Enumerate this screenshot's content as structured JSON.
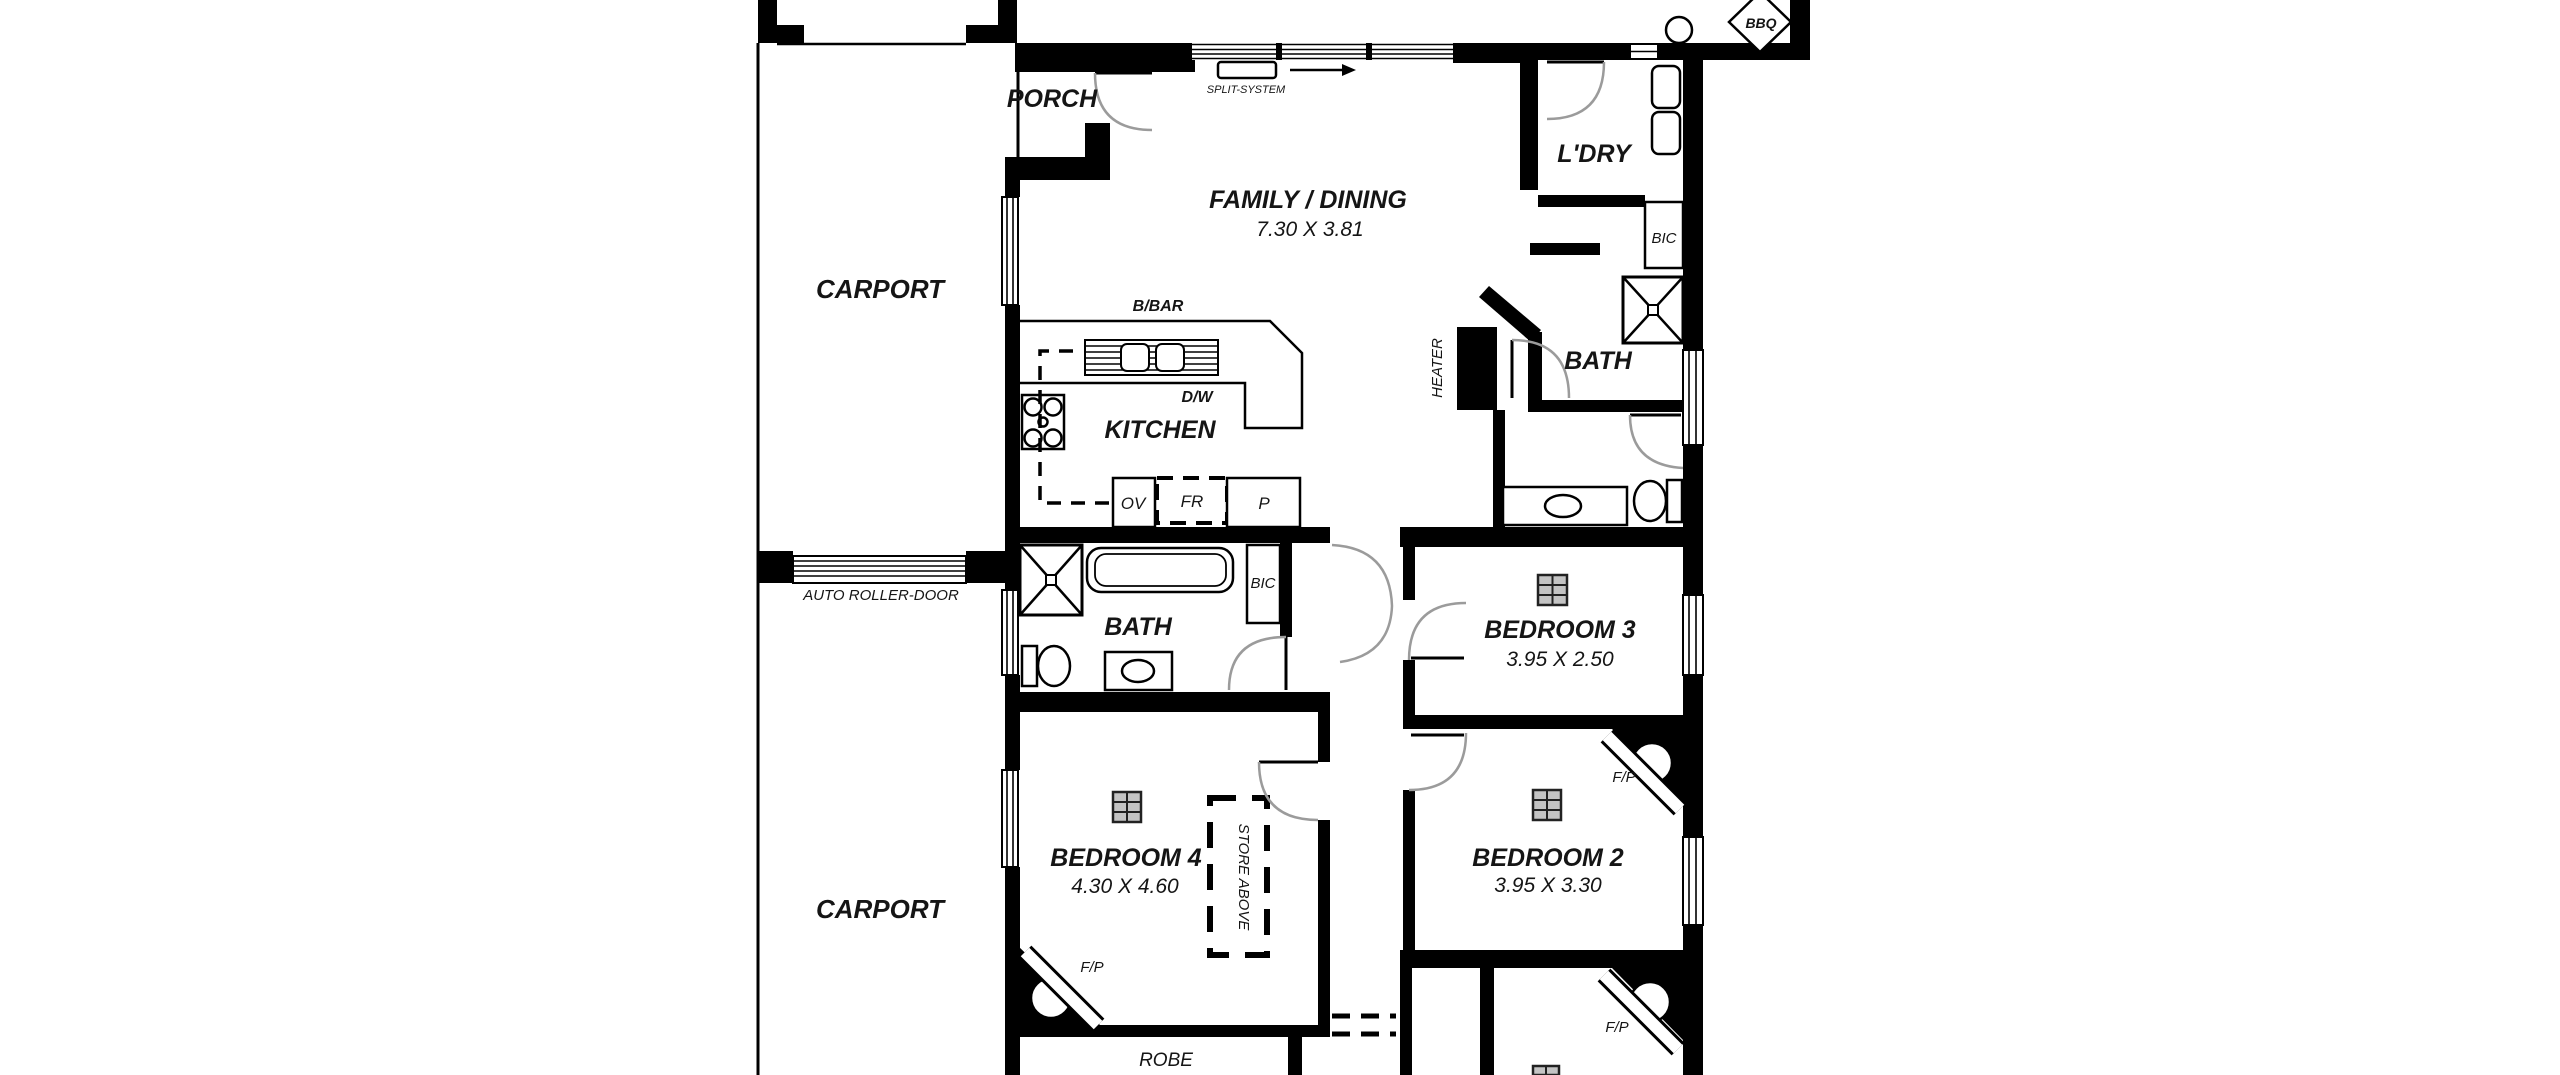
{
  "plan": {
    "rooms": {
      "carport_front": {
        "label": "CARPORT"
      },
      "carport_rear": {
        "label": "CARPORT"
      },
      "porch": {
        "label": "PORCH"
      },
      "family_dining": {
        "label": "FAMILY / DINING",
        "dims": "7.30 X 3.81"
      },
      "kitchen": {
        "label": "KITCHEN"
      },
      "laundry": {
        "label": "L'DRY"
      },
      "bath_main": {
        "label": "BATH"
      },
      "bath_two": {
        "label": "BATH"
      },
      "bedroom2": {
        "label": "BEDROOM 2",
        "dims": "3.95 X 3.30"
      },
      "bedroom3": {
        "label": "BEDROOM 3",
        "dims": "3.95 X 2.50"
      },
      "bedroom4": {
        "label": "BEDROOM 4",
        "dims": "4.30 X 4.60"
      },
      "robe": {
        "label": "ROBE"
      }
    },
    "annotations": {
      "split_system": "SPLIT-SYSTEM",
      "breakfast_bar": "B/BAR",
      "dishwasher": "D/W",
      "oven": "OV",
      "fridge": "FR",
      "pantry": "P",
      "heater": "HEATER",
      "bic_laundry": "BIC",
      "bic_hall": "BIC",
      "bbq": "BBQ",
      "auto_roller_door": "AUTO ROLLER-DOOR",
      "store_above": "STORE ABOVE",
      "fp_bedroom2": "F/P",
      "fp_bedroom4": "F/P",
      "fp_bedroom1": "F/P"
    },
    "colors": {
      "wall": "#000000",
      "background": "#ffffff",
      "door_arc": "#999999",
      "label": "#151515"
    }
  }
}
